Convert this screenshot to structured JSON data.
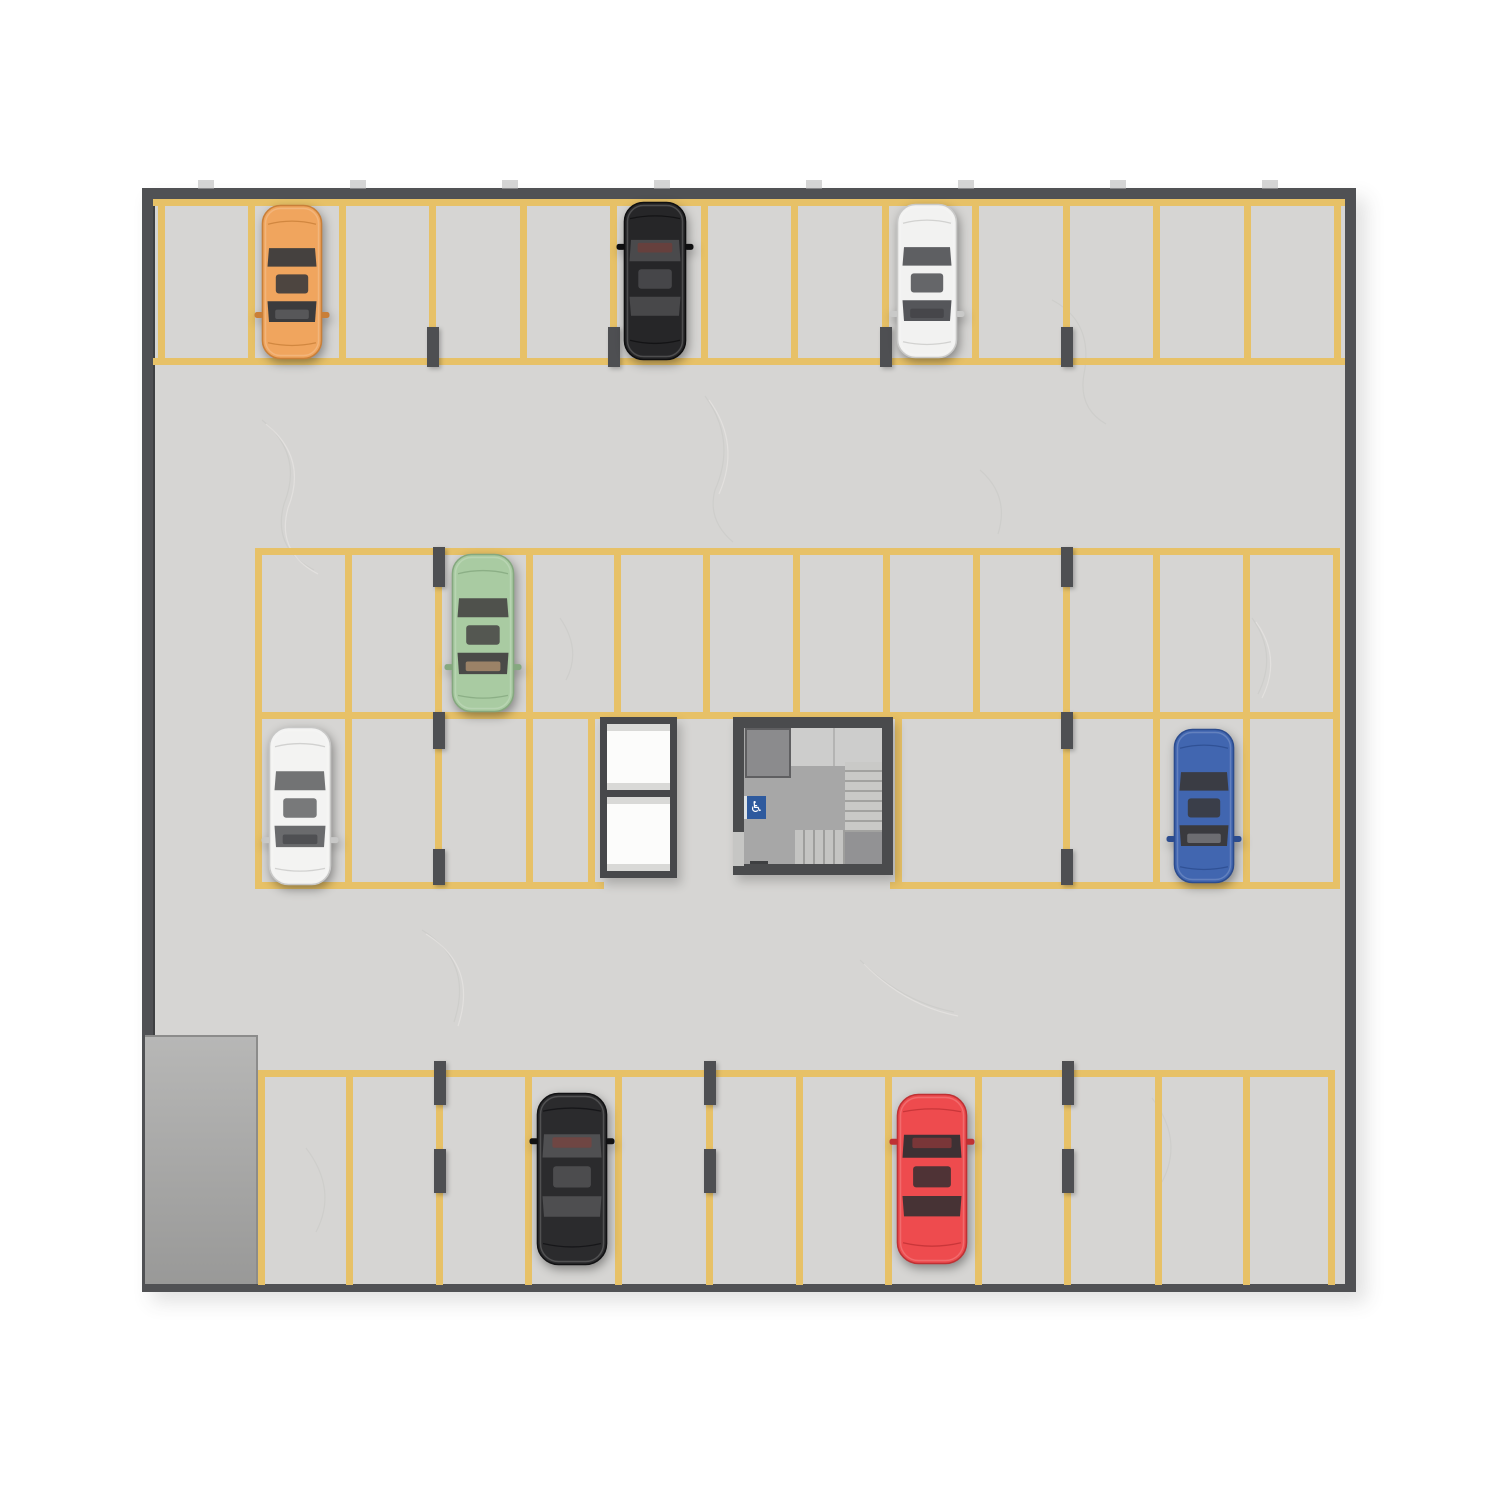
{
  "scene": {
    "description": "Top-down 3D floor-plan render of an underground parking level with yellow stall striping, eight parked cars, two elevator shafts, a stairwell with accessibility sign, support pillars and an entry ramp",
    "canvas": {
      "w": 1500,
      "h": 1500,
      "background": "#ffffff"
    },
    "palette": {
      "floor": "#d6d5d3",
      "wall": "#505154",
      "stall_line": "#e7c167",
      "pillar": "#4e4f52",
      "ramp_top": "#b7b7b6",
      "ramp_bottom": "#999998",
      "block_frame": "#47484b",
      "elevator_cabin": "#fcfcfb",
      "stair_floor": "#a7a7a7",
      "accessibility_blue": "#2e5a9e"
    },
    "garage": {
      "x": 142,
      "y": 188,
      "w": 1214,
      "h": 1104,
      "wall_side": 11,
      "wall_top": 11,
      "wall_bottom": 8,
      "floor": "#d6d5d3",
      "wall_color": "#505154"
    },
    "wall_ticks": {
      "y": 180,
      "w": 16,
      "h": 9,
      "color": "#b3b3b2",
      "xs": [
        198,
        350,
        502,
        654,
        806,
        958,
        1110,
        1262
      ]
    },
    "ramp": {
      "x": 145,
      "y": 1035,
      "w": 113,
      "h": 249,
      "fill_top": "#b7b7b6",
      "fill_bottom": "#999998",
      "edge": "#8c8c8b"
    },
    "striping": {
      "color": "#e7c167",
      "line_w": 7,
      "rows": [
        {
          "name": "top-row",
          "v_from": 199,
          "v_to": 365,
          "v": [
            158,
            248,
            339,
            429,
            520,
            610,
            701,
            791,
            882,
            972,
            1063,
            1153,
            1244,
            1334
          ],
          "h": [
            [
              153,
              199,
              1192
            ],
            [
              153,
              358,
              1192
            ]
          ]
        },
        {
          "name": "middle-upper-row",
          "v_from": 548,
          "v_to": 719,
          "v": [
            255,
            345,
            435,
            526,
            614,
            703,
            793,
            883,
            973,
            1063,
            1153,
            1243,
            1333
          ],
          "h": [
            [
              255,
              548,
              1085
            ]
          ]
        },
        {
          "name": "middle-lower-row",
          "v_from": 712,
          "v_to": 889,
          "v": [
            255,
            345,
            435,
            526,
            588,
            895,
            1063,
            1153,
            1243,
            1333
          ],
          "h": [
            [
              255,
              712,
              1085
            ],
            [
              255,
              882,
              349
            ],
            [
              890,
              882,
              450
            ]
          ]
        },
        {
          "name": "bottom-row",
          "v_from": 1070,
          "v_to": 1285,
          "v": [
            258,
            346,
            436,
            525,
            615,
            706,
            796,
            885,
            975,
            1064,
            1155,
            1243,
            1328
          ],
          "h": [
            [
              258,
              1070,
              1077
            ]
          ]
        }
      ]
    },
    "pillars": {
      "w": 12,
      "color": "#4e4f52",
      "items": [
        {
          "x": 429,
          "segs": [
            [
              327,
              40
            ]
          ]
        },
        {
          "x": 610,
          "segs": [
            [
              327,
              40
            ]
          ]
        },
        {
          "x": 882,
          "segs": [
            [
              327,
              40
            ]
          ]
        },
        {
          "x": 1063,
          "segs": [
            [
              327,
              40
            ]
          ]
        },
        {
          "x": 435,
          "segs": [
            [
              547,
              40
            ],
            [
              712,
              37
            ],
            [
              849,
              36
            ]
          ]
        },
        {
          "x": 1063,
          "segs": [
            [
              547,
              40
            ],
            [
              712,
              37
            ],
            [
              849,
              36
            ]
          ]
        },
        {
          "x": 436,
          "segs": [
            [
              1061,
              44
            ],
            [
              1149,
              44
            ]
          ]
        },
        {
          "x": 706,
          "segs": [
            [
              1061,
              44
            ],
            [
              1149,
              44
            ]
          ]
        },
        {
          "x": 1064,
          "segs": [
            [
              1061,
              44
            ],
            [
              1149,
              44
            ]
          ]
        }
      ]
    },
    "elevator_block": {
      "x": 600,
      "y": 717,
      "w": 77,
      "h": 161,
      "frame": "#47484b",
      "frame_t": 7,
      "cabin_fill": "#fcfcfb",
      "cabin_band": "#d9d9d7",
      "cabins": [
        {
          "y": 7,
          "h": 66
        },
        {
          "y": 80,
          "h": 74
        }
      ]
    },
    "stairwell": {
      "x": 733,
      "y": 717,
      "w": 160,
      "h": 158,
      "wall": "#4a4b4d",
      "wall_t": 11,
      "floor": "#a7a7a7",
      "room": {
        "x": 12,
        "y": 11,
        "w": 46,
        "h": 50,
        "fill": "#8b8b8d",
        "border": "#5f5f61"
      },
      "landing": {
        "x": 58,
        "y": 11,
        "w": 91,
        "h": 38,
        "fill": "#cdcdcc",
        "seam_x": 100
      },
      "flight_right": {
        "x": 112,
        "y": 45,
        "w": 37,
        "h": 70,
        "light": "#c9c9c7",
        "dark": "#a2a2a0",
        "dir": "v"
      },
      "corner": {
        "x": 112,
        "y": 115,
        "w": 37,
        "h": 32,
        "fill": "#929294"
      },
      "flight_bottom": {
        "x": 62,
        "y": 113,
        "w": 50,
        "h": 34,
        "light": "#c4c4c2",
        "dark": "#9e9e9c",
        "dir": "h"
      },
      "door_gap": {
        "x": 0,
        "y": 115,
        "w": 11,
        "h": 34,
        "fill": "#c6c6c4"
      },
      "door_line": {
        "x": 17,
        "y": 144,
        "w": 18,
        "h": 3,
        "fill": "#3e3f41"
      }
    },
    "accessibility_sign": {
      "x": 744,
      "y": 796,
      "w": 22,
      "h": 23,
      "fill": "#2e5a9e",
      "edge": "#dde2e6",
      "glyph": "♿",
      "glyph_color": "#ffffff"
    },
    "cars": [
      {
        "id": "car-orange-top",
        "row": "top-row",
        "color": "#f0a55e",
        "shade": "#c97f38",
        "glass": "#3b3b3d",
        "interior": "#6b6b6d",
        "cx": 292,
        "cy": 282,
        "len": 154,
        "wid": 60,
        "facing": "down"
      },
      {
        "id": "car-black-top",
        "row": "top-row",
        "color": "#262628",
        "shade": "#0f0f10",
        "glass": "#4a4a4c",
        "interior": "#7a3b34",
        "cx": 655,
        "cy": 281,
        "len": 158,
        "wid": 62,
        "facing": "up"
      },
      {
        "id": "car-white-top",
        "row": "top-row",
        "color": "#f2f2f1",
        "shade": "#c9c9c8",
        "glass": "#55565a",
        "interior": "#3c3c40",
        "cx": 927,
        "cy": 281,
        "len": 154,
        "wid": 60,
        "facing": "down"
      },
      {
        "id": "car-green",
        "row": "middle-upper-row",
        "color": "#a9cba2",
        "shade": "#85a87f",
        "glass": "#4a4a48",
        "interior": "#d2a87d",
        "cx": 483,
        "cy": 633,
        "len": 158,
        "wid": 62,
        "facing": "down"
      },
      {
        "id": "car-white-middle",
        "row": "middle-lower-row",
        "color": "#f3f3f2",
        "shade": "#c8c8c7",
        "glass": "#6a6b6d",
        "interior": "#3d3e42",
        "cx": 300,
        "cy": 806,
        "len": 158,
        "wid": 62,
        "facing": "down"
      },
      {
        "id": "car-blue",
        "row": "middle-lower-row",
        "color": "#4166b0",
        "shade": "#2c4c8e",
        "glass": "#3a3a3e",
        "interior": "#8f9094",
        "cx": 1204,
        "cy": 806,
        "len": 154,
        "wid": 60,
        "facing": "down"
      },
      {
        "id": "car-black-bottom",
        "row": "bottom-row",
        "color": "#2b2b2d",
        "shade": "#121214",
        "glass": "#505052",
        "interior": "#84403a",
        "cx": 572,
        "cy": 1179,
        "len": 172,
        "wid": 70,
        "facing": "up"
      },
      {
        "id": "car-red",
        "row": "bottom-row",
        "color": "#ee4b4e",
        "shade": "#bf3134",
        "glass": "#3d3134",
        "interior": "#a43b3c",
        "cx": 932,
        "cy": 1179,
        "len": 170,
        "wid": 70,
        "facing": "up"
      }
    ],
    "summary": {
      "car_count": 8,
      "parking_rows": 4,
      "elevators": 2
    }
  }
}
